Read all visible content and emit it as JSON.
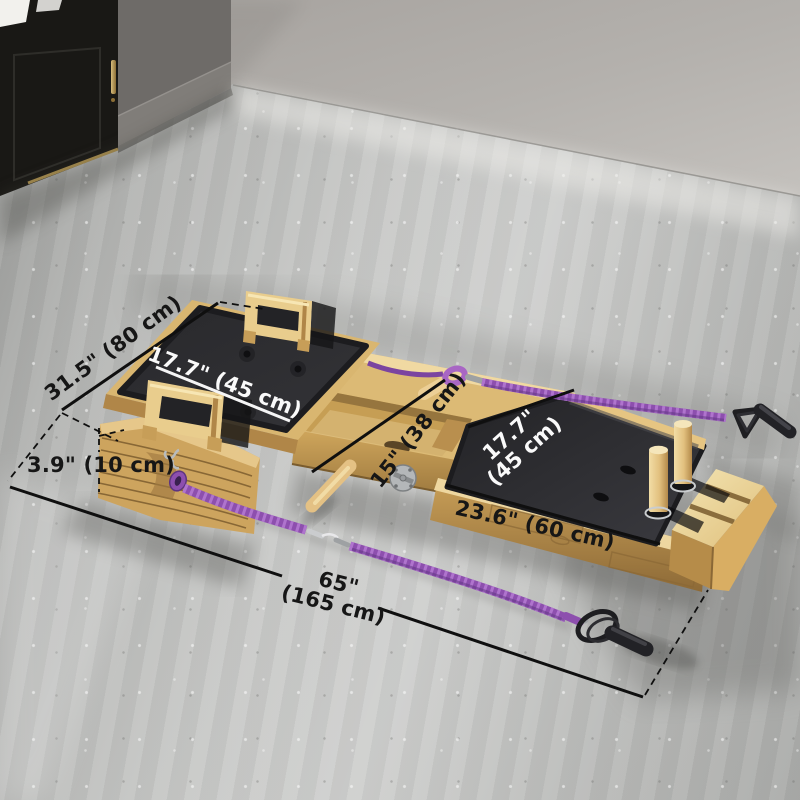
{
  "dimensions": {
    "frame_width": "31.5\" (80 cm)",
    "carriage_pad_width": "17.7\" (45 cm)",
    "base_height": "3.9\" (10 cm)",
    "rail_width": "15\" (38 cm)",
    "platform_pad_width_line1": "17.7\"",
    "platform_pad_width_line2": "(45 cm)",
    "footboard_length": "23.6\" (60 cm)",
    "total_length_line1": "65\"",
    "total_length_line2": "(165 cm)"
  },
  "colors": {
    "wood_light": "#eed7a0",
    "wood_mid": "#dcb873",
    "wood_dark": "#9c7840",
    "upholstery_black": "#27272a",
    "resistance_band_purple": "#8d4fae",
    "annotation_dark": "#161616",
    "annotation_light": "#fafafa",
    "floor_gray": "#c2c3c1",
    "door_black": "#191815"
  }
}
